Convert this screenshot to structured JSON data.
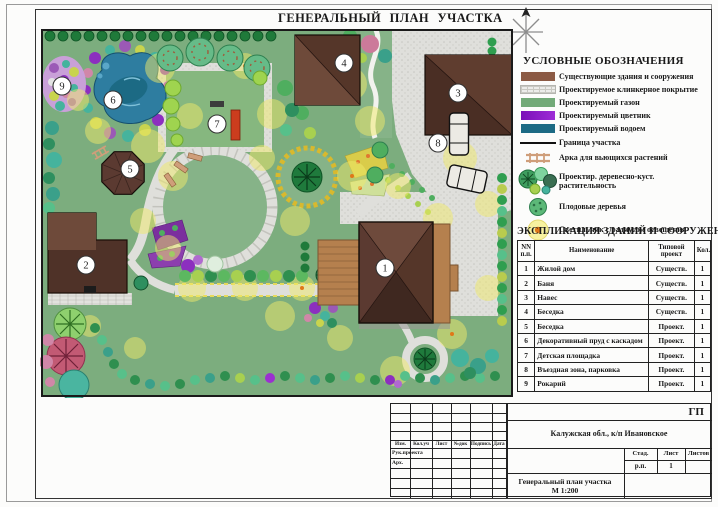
{
  "page": {
    "title": "ГЕНЕРАЛЬНЫЙ ПЛАН УЧАСТКА"
  },
  "plan": {
    "markers": [
      "1",
      "2",
      "3",
      "4",
      "5",
      "6",
      "7",
      "8",
      "9"
    ]
  },
  "legend": {
    "title": "УСЛОВНЫЕ ОБОЗНАЧЕНИЯ",
    "items": [
      {
        "icon": "swatch-existing-buildings",
        "label": "Существующие здания и сооружения",
        "color": "#8b5a44"
      },
      {
        "icon": "swatch-clinker-paving",
        "label": "Проектируемое клинкерное покрытие",
        "color": "#ececea"
      },
      {
        "icon": "swatch-lawn",
        "label": "Проектируемый газон",
        "color": "#72aa78"
      },
      {
        "icon": "swatch-flowerbed",
        "label": "Проектируемый цветник",
        "color": "#8c16c8"
      },
      {
        "icon": "swatch-pond",
        "label": "Проектируемый водоем",
        "color": "#1c6a84"
      },
      {
        "icon": "boundary-line",
        "label": "Граница участка",
        "color": "#111111"
      },
      {
        "icon": "arch-icon",
        "label": "Арка для вьющихся растений",
        "color": "#cf9e7a"
      },
      {
        "icon": "tree-cluster-icon",
        "label": "Проектир. деревесно-куст. растительность"
      },
      {
        "icon": "fruit-tree-icon",
        "label": "Плодовые деревья"
      },
      {
        "icon": "lamp-icon",
        "label": "Светильник с радиусом освещения"
      }
    ]
  },
  "explication": {
    "title": "ЭКСПЛИКАЦИЯ ЗДАНИЙ И СООРУЖЕНИЙ",
    "columns": [
      "NN п.п.",
      "Наименование",
      "Типовой проект",
      "Кол."
    ],
    "rows": [
      [
        "1",
        "Жилой дом",
        "Существ.",
        "1"
      ],
      [
        "2",
        "Баня",
        "Существ.",
        "1"
      ],
      [
        "3",
        "Навес",
        "Существ.",
        "1"
      ],
      [
        "4",
        "Беседка",
        "Существ.",
        "1"
      ],
      [
        "5",
        "Беседка",
        "Проект.",
        "1"
      ],
      [
        "6",
        "Декоративный пруд с каскадом",
        "Проект.",
        "1"
      ],
      [
        "7",
        "Детская площадка",
        "Проект.",
        "1"
      ],
      [
        "8",
        "Въездная зона, парковка",
        "Проект.",
        "1"
      ],
      [
        "9",
        "Рокарий",
        "Проект.",
        "1"
      ]
    ]
  },
  "stamp": {
    "code": "ГП",
    "location": "Калужская обл., к/п Ивановское",
    "header_cells": [
      "Изм.",
      "Кол.уч",
      "Лист",
      "№док",
      "Подпись",
      "Дата"
    ],
    "row_labels": [
      "Рук.проекта",
      "Арх."
    ],
    "stage_label": "Стад.",
    "sheet_label": "Лист",
    "sheets_label": "Листов",
    "stage_value": "р.п.",
    "sheet_value": "1",
    "doc_title": "Генеральный план участка",
    "scale": "М 1:200"
  }
}
